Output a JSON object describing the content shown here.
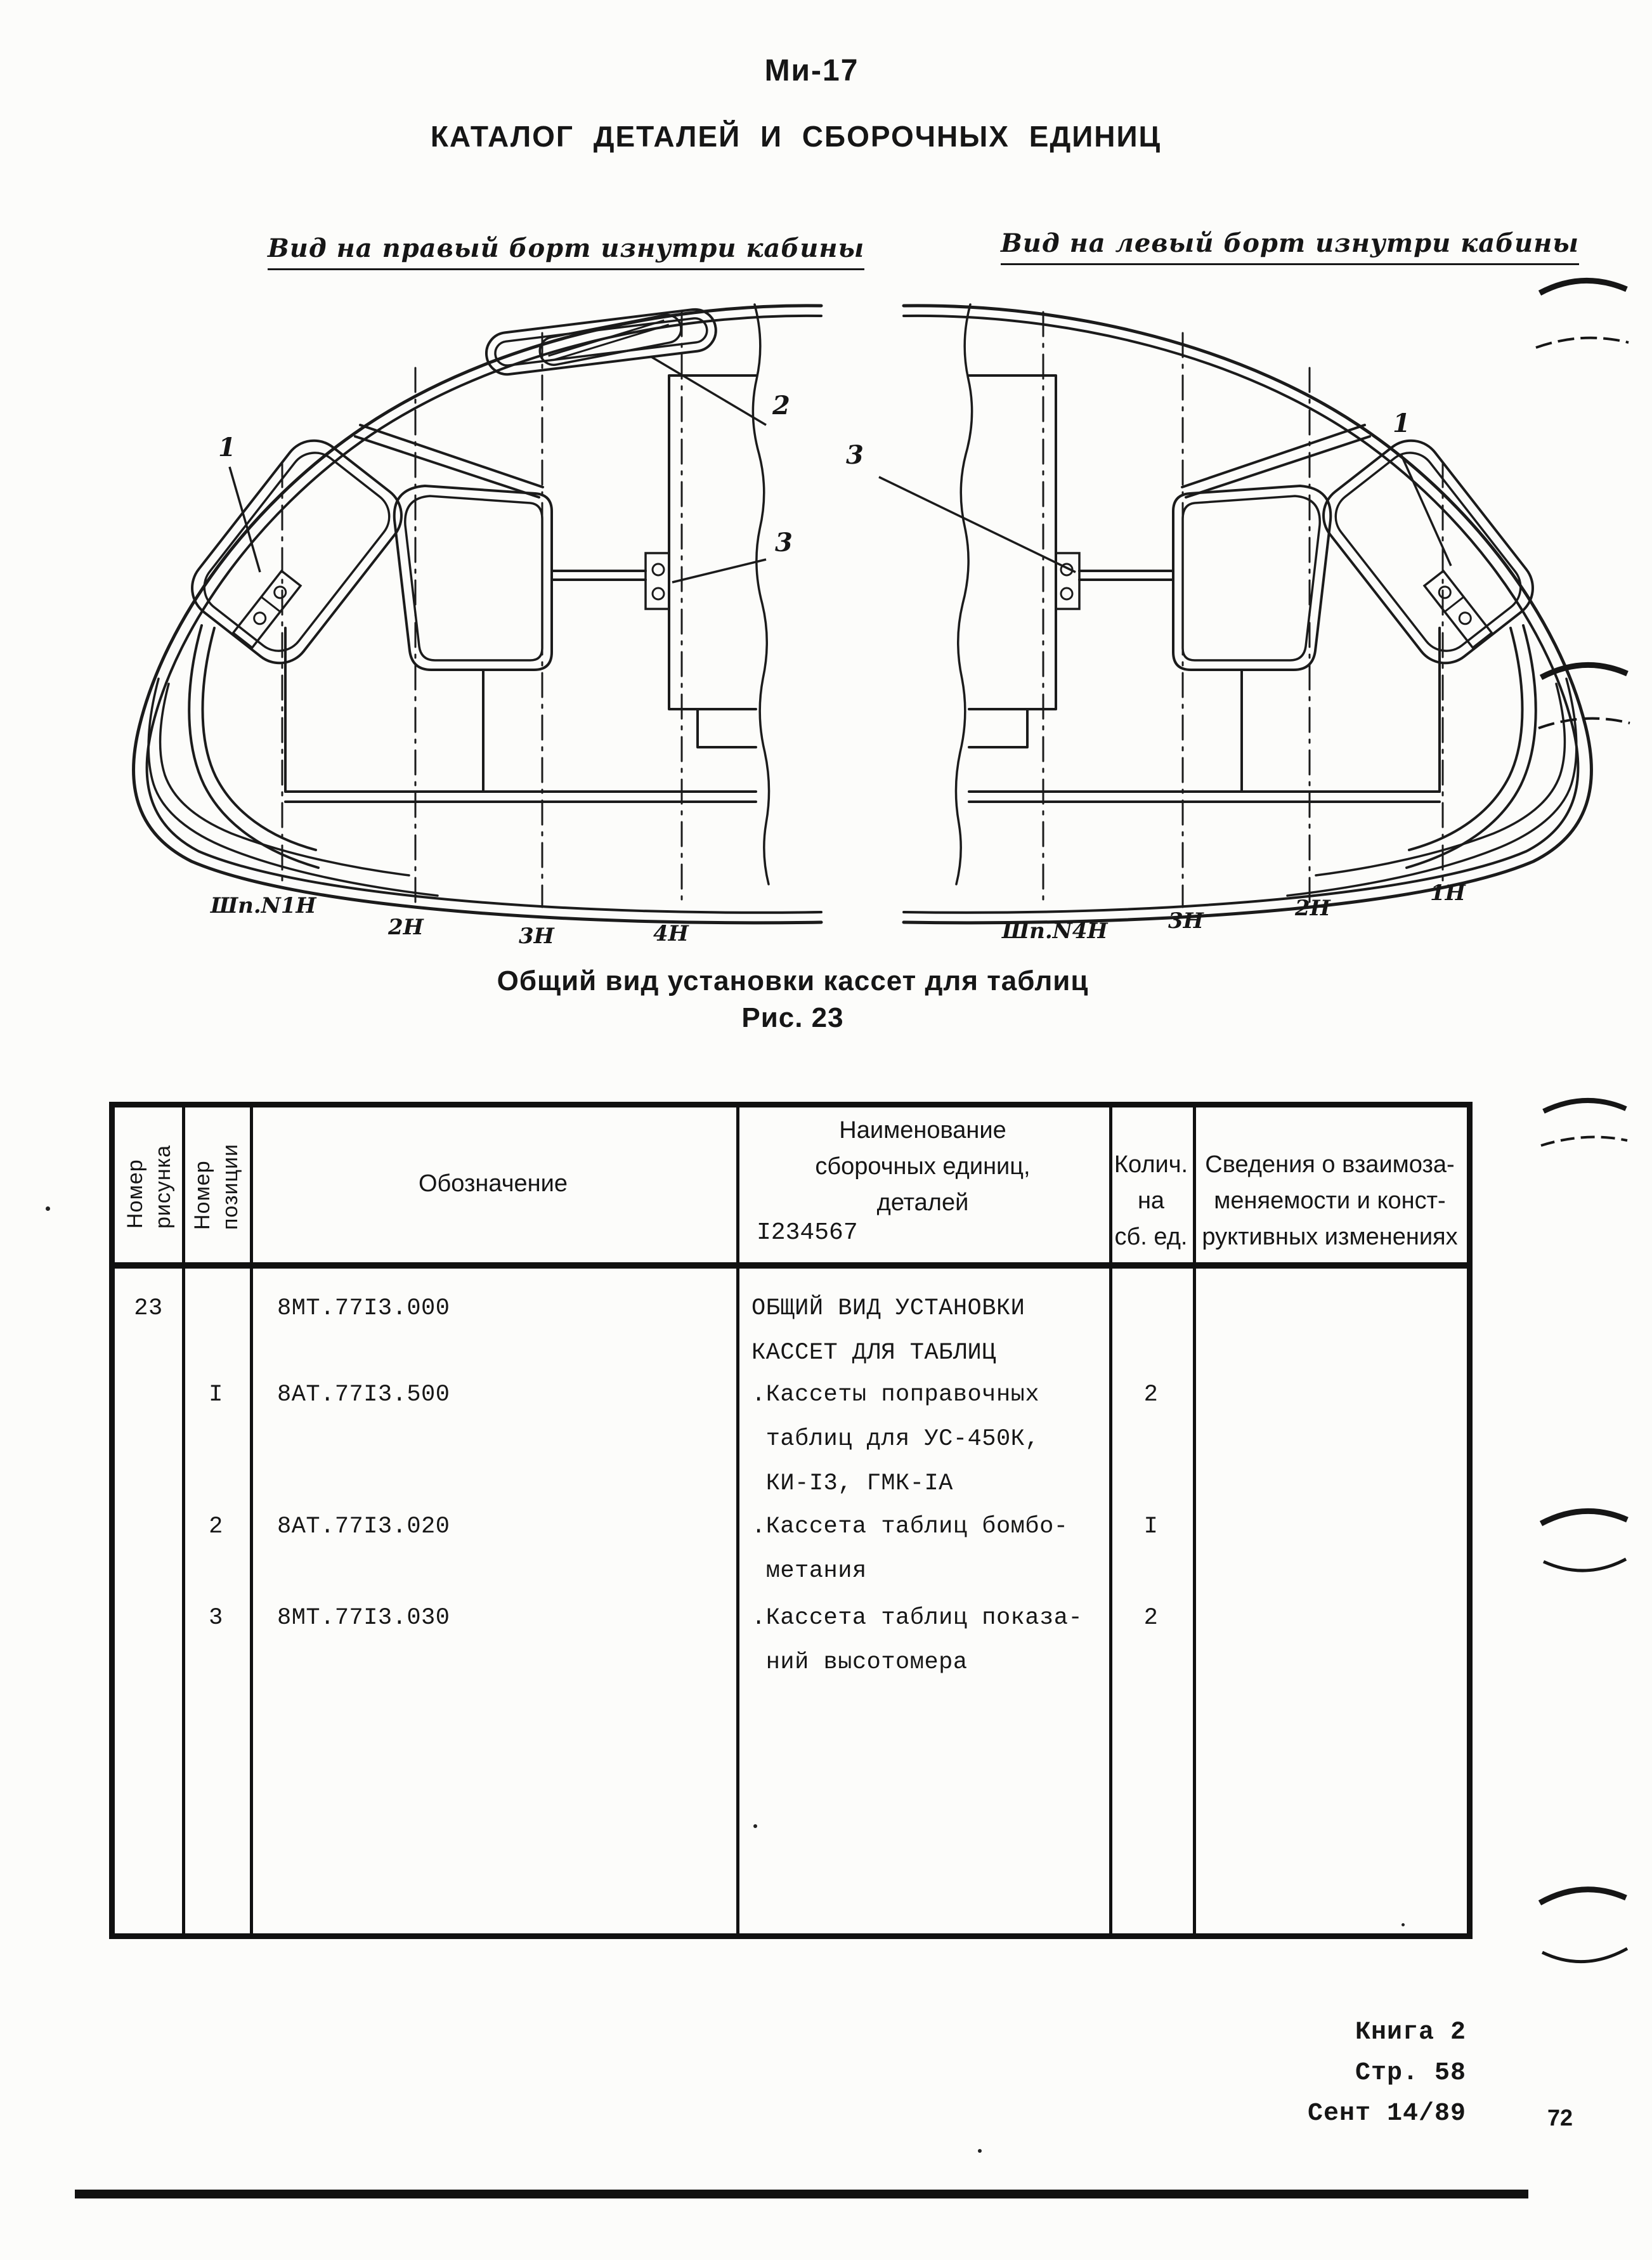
{
  "header": {
    "aircraft": "Ми-17",
    "title": "КАТАЛОГ ДЕТАЛЕЙ И СБОРОЧНЫХ ЕДИНИЦ"
  },
  "figure": {
    "right_board_label": "Вид на правый борт изнутри кабины",
    "left_board_label": "Вид на левый борт изнутри кабины",
    "caption": "Общий вид установки кассет для таблиц",
    "figure_number": "Рис. 23",
    "left_diagram": {
      "stations": [
        "Шп.N1Н",
        "2Н",
        "3Н",
        "4Н"
      ],
      "callouts": [
        "1",
        "2",
        "3"
      ]
    },
    "right_diagram": {
      "stations": [
        "Шп.N4Н",
        "3Н",
        "2Н",
        "1Н"
      ],
      "callouts": [
        "3",
        "1"
      ]
    }
  },
  "table": {
    "col_fig": "Номер\nрисунка",
    "col_pos": "Номер\nпозиции",
    "col_designation": "Обозначение",
    "col_name": "Наименование\nсборочных единиц,\nдеталей",
    "col_name_note": "I234567",
    "col_qty": "Колич.\nна\nсб. ед.",
    "col_notes": "Сведения о взаимоза-\nменяемости и конст-\nруктивных изменениях",
    "rows": [
      {
        "fig": "23",
        "pos": "",
        "designation": "8МТ.77I3.000",
        "name": "ОБЩИЙ ВИД УСТАНОВКИ\nКАССЕТ ДЛЯ ТАБЛИЦ",
        "qty": ""
      },
      {
        "fig": "",
        "pos": "I",
        "designation": "8АТ.77I3.500",
        "name": ".Кассеты поправочных\n таблиц для УС-450К,\n КИ-I3, ГМК-IА",
        "qty": "2"
      },
      {
        "fig": "",
        "pos": "2",
        "designation": "8АТ.77I3.020",
        "name": ".Кассета таблиц бомбо-\n метания",
        "qty": "I"
      },
      {
        "fig": "",
        "pos": "3",
        "designation": "8МТ.77I3.030",
        "name": ".Кассета таблиц показа-\n ний высотомера",
        "qty": "2"
      }
    ]
  },
  "footer": {
    "book": "Книга 2",
    "page": "Стр. 58",
    "date": "Сент 14/89",
    "sheet_number": "72"
  }
}
